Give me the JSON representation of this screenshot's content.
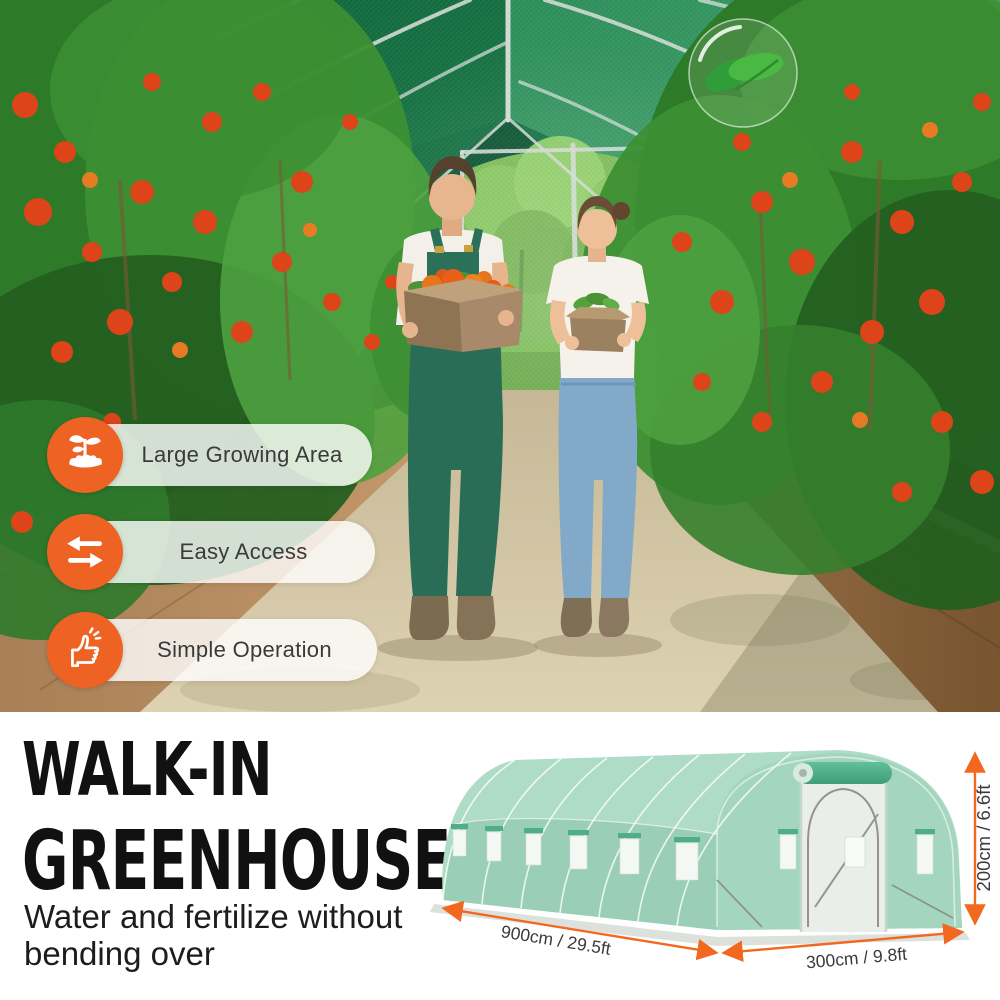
{
  "hero": {
    "features": [
      {
        "icon": "seedling-icon",
        "label": "Large Growing Area"
      },
      {
        "icon": "swap-arrows-icon",
        "label": "Easy Access"
      },
      {
        "icon": "thumbs-up-icon",
        "label": "Simple Operation"
      }
    ]
  },
  "info": {
    "title_line1": "WALK-IN",
    "title_line2": "GREENHOUSE",
    "subtitle": "Water and fertilize without bending over"
  },
  "diagram": {
    "dim_length": "900cm / 29.5ft",
    "dim_width": "300cm / 9.8ft",
    "dim_height": "200cm / 6.6ft"
  },
  "colors": {
    "accent_orange": "#EE6224",
    "dimension_arrow": "#F2681F",
    "greenhouse_mint": "#A6D8C2",
    "title_text": "#111111"
  }
}
